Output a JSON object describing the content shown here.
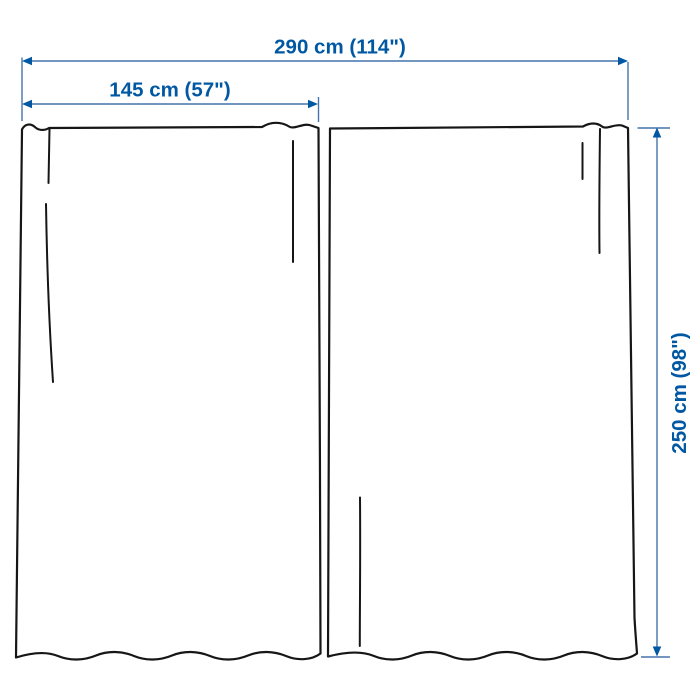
{
  "diagram": {
    "dimensions": {
      "total_width": {
        "label": "290 cm (114\")",
        "cm": 290,
        "inches": 114
      },
      "panel_width": {
        "label": "145 cm (57\")",
        "cm": 145,
        "inches": 57
      },
      "height": {
        "label": "250 cm (98\")",
        "cm": 250,
        "inches": 98
      }
    },
    "panels": {
      "count": 2
    },
    "icons": {
      "dimension_arrows": [
        "arrow-left-icon",
        "arrow-right-icon",
        "arrow-up-icon",
        "arrow-down-icon"
      ]
    },
    "colors": {
      "bg": "#FFFFFF",
      "outline": "#161616",
      "line": "#4573AC",
      "arrow": "#0058A3",
      "text": "#0058A3"
    }
  }
}
